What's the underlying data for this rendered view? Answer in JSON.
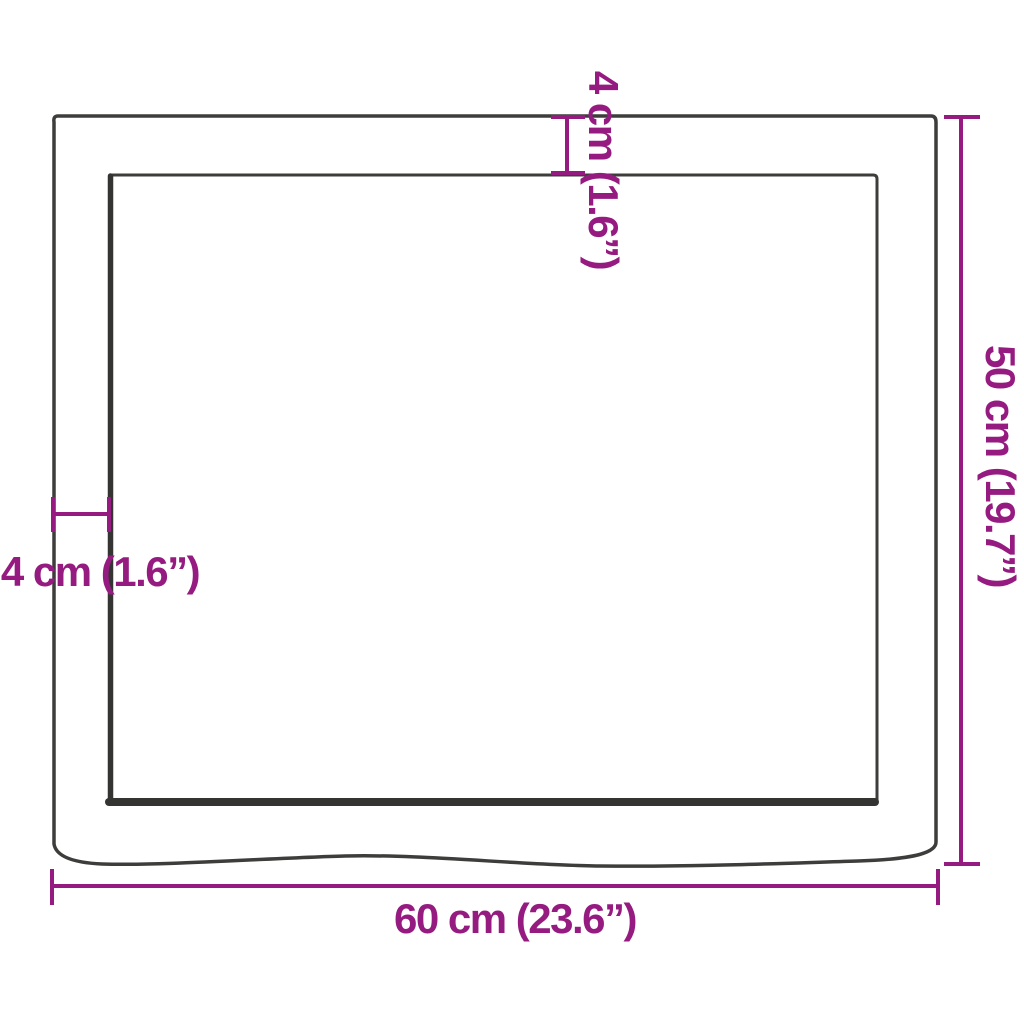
{
  "diagram": {
    "colors": {
      "dimension_accent": "#951b81",
      "board_outline": "#3d3d3c",
      "background": "#ffffff"
    },
    "dimensions": {
      "width_label": "60 cm (23.6”)",
      "height_label": "50 cm (19.7”)",
      "thickness_top_label": "4 cm (1.6”)",
      "thickness_left_label": "4 cm (1.6”)"
    }
  }
}
